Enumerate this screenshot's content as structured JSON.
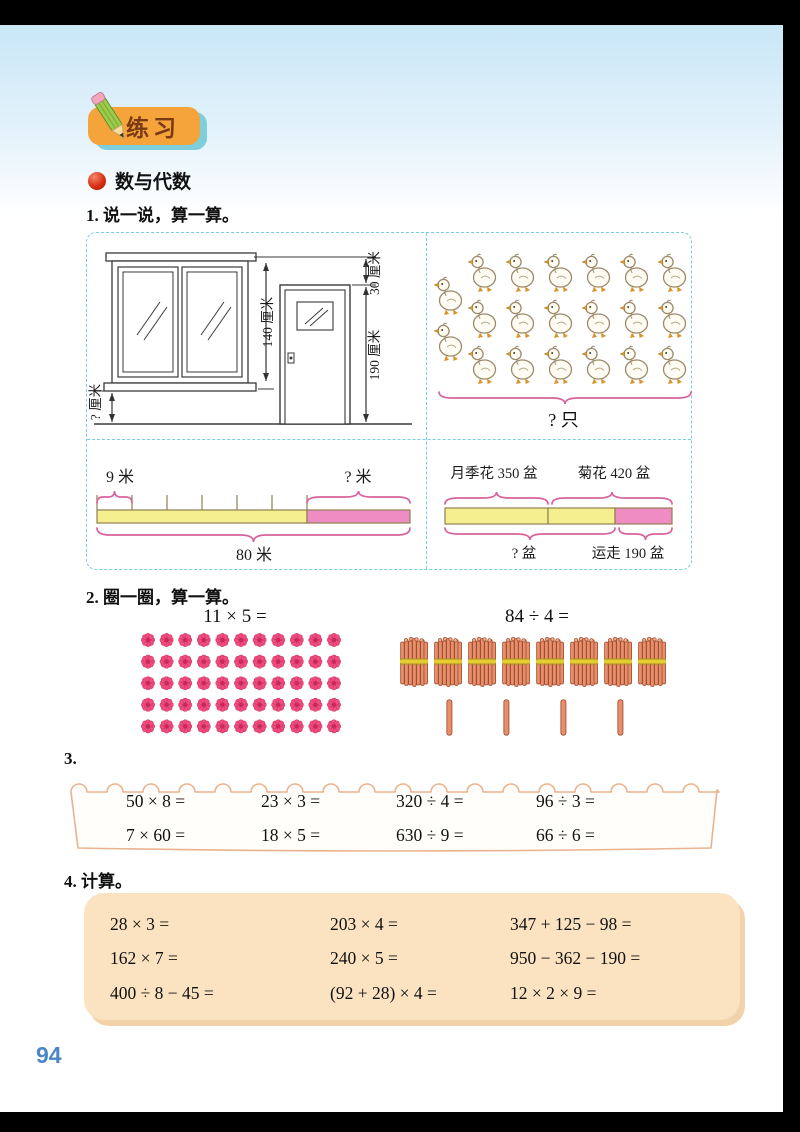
{
  "page_number": "94",
  "header": {
    "tab_label": "练习",
    "section_title": "数与代数"
  },
  "icons": {
    "tab": "pencil-icon",
    "section": "red-sphere-icon"
  },
  "p1": {
    "title": "1. 说一说，算一算。",
    "room": {
      "window_height": "140 厘米",
      "gap_height": "30 厘米",
      "door_height": "190 厘米",
      "sill_height": "? 厘米"
    },
    "ducks": {
      "question": "? 只",
      "layout": {
        "side_column": 2,
        "cols": 6,
        "rows": 3
      }
    },
    "rope_bar": {
      "first_segment": "9 米",
      "unknown": "? 米",
      "total": "80 米"
    },
    "flower_bar": {
      "left_label": "月季花 350 盆",
      "right_label": "菊花 420 盆",
      "question": "? 盆",
      "removed": "运走 190 盆"
    }
  },
  "p2": {
    "title": "2. 圈一圈，算一算。",
    "left_expr": "11 × 5 =",
    "right_expr": "84 ÷ 4 =",
    "flowers": {
      "rows": 5,
      "cols": 11
    },
    "sticks": {
      "bundles": 8,
      "singles": 4
    }
  },
  "p3": {
    "label": "3.",
    "exprs": [
      [
        "50 × 8 =",
        "23 × 3 =",
        "320 ÷ 4 =",
        "96 ÷ 3 ="
      ],
      [
        "7 × 60 =",
        "18 × 5 =",
        "630 ÷ 9 =",
        "66 ÷ 6 ="
      ]
    ]
  },
  "p4": {
    "title": "4. 计算。",
    "exprs": [
      [
        "28 × 3 =",
        "203 × 4 =",
        "347 + 125 − 98 ="
      ],
      [
        "162 × 7 =",
        "240 × 5 =",
        "950 − 362 − 190 ="
      ],
      [
        "400 ÷ 8 − 45 =",
        "(92 + 28) × 4 =",
        "12 × 2 × 9 ="
      ]
    ]
  },
  "colors": {
    "tab_bg": "#f5a43c",
    "tab_shadow": "#7ecfdb",
    "dash_cyan": "#74cfdf",
    "bar_yellow": "#f6ef8f",
    "bar_pink": "#f08cc4",
    "bar_stroke": "#8f7f52",
    "brace_pink": "#d8639c",
    "flower_pink": "#ee4d7d",
    "stick_orange": "#e78f6c",
    "band_yellow": "#e6cb33",
    "p4_bg": "#fbe3c1",
    "strip_edge": "#eab38f",
    "page_num_blue": "#4a86c8"
  }
}
